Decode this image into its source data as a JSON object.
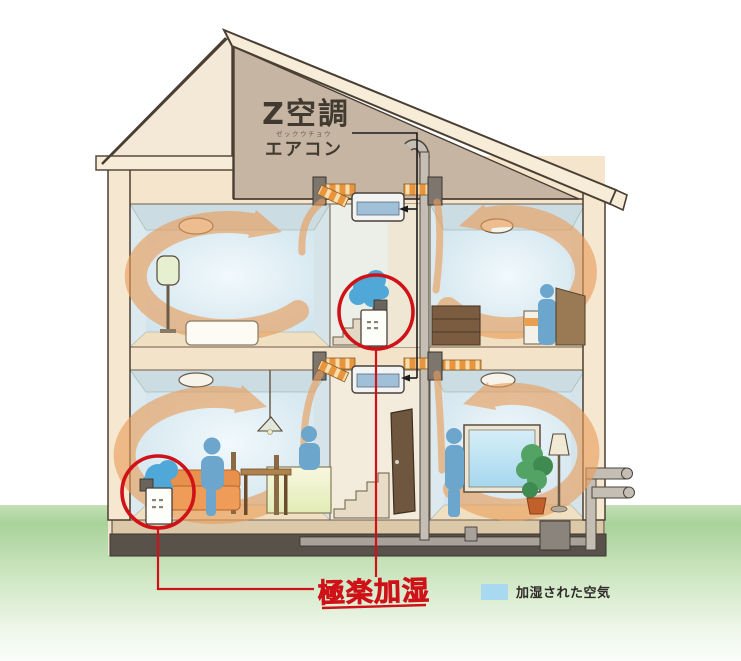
{
  "illustration": {
    "attic_unit": {
      "name": "Z空調",
      "reading": "ゼックウチョウ",
      "type": "エアコン"
    },
    "highlight": {
      "label": "極楽加湿"
    },
    "legend": {
      "label": "加湿された空気",
      "swatch_color": "#a9d9f1"
    },
    "colors": {
      "outline": "#4a3f33",
      "wall_fill": "#f5e5cd",
      "attic_fill": "#c6b5a2",
      "roof_fill": "#f6ecd8",
      "room_air_blue": "#d9ecf5",
      "airflow_orange": "#e89c58",
      "duct_orange": "#e8953f",
      "mist_blue": "#4fa8d8",
      "highlight_red": "#cf1118",
      "ground_green": "#a8d199",
      "foundation_dark": "#59524a"
    }
  }
}
